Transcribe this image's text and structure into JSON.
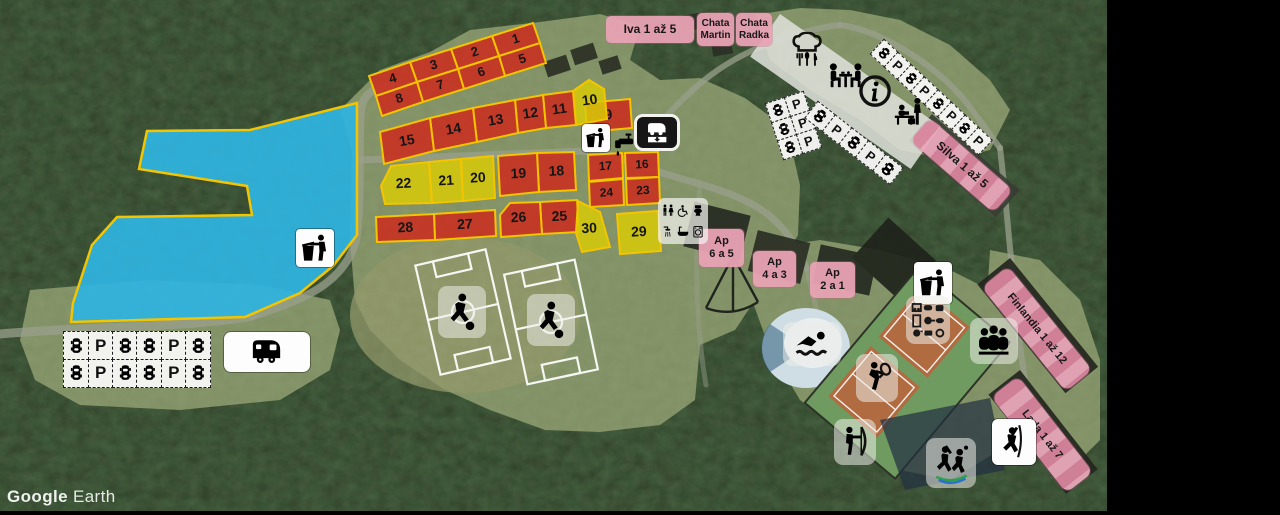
{
  "watermark": {
    "brand": "Google",
    "product": "Earth"
  },
  "colors": {
    "plot_red": "#cd2a1d",
    "plot_yellow": "#d8ca08",
    "plot_border": "#f3c400",
    "lake_fill": "#2fb4e0",
    "label_pink": "#e8a2b4",
    "forest": "#2c3c24",
    "meadow": "#7f8f63"
  },
  "lake": {
    "points": "357,103 250,130 147,131 139,169 247,186 252,215 117,217 92,245 73,303 71,322 245,317 300,293 333,266 357,235"
  },
  "plots": [
    {
      "n": "1",
      "c": "r",
      "fs": 13,
      "tr": -17,
      "pts": "492,36 533,23 540,43 499,56"
    },
    {
      "n": "2",
      "c": "r",
      "fs": 13,
      "tr": -17,
      "pts": "451,49 492,36 499,56 458,69"
    },
    {
      "n": "3",
      "c": "r",
      "fs": 13,
      "tr": -17,
      "pts": "410,62 451,49 458,69 417,82"
    },
    {
      "n": "4",
      "c": "r",
      "fs": 13,
      "tr": -17,
      "pts": "369,76 410,62 417,82 376,96"
    },
    {
      "n": "5",
      "c": "r",
      "fs": 13,
      "tr": -17,
      "pts": "499,56 540,43 546,63 505,76"
    },
    {
      "n": "6",
      "c": "r",
      "fs": 13,
      "tr": -17,
      "pts": "458,69 499,56 505,76 464,89"
    },
    {
      "n": "7",
      "c": "r",
      "fs": 13,
      "tr": -17,
      "pts": "417,82 458,69 464,89 423,102"
    },
    {
      "n": "8",
      "c": "r",
      "fs": 13,
      "tr": -17,
      "pts": "376,96 417,82 423,102 382,116"
    },
    {
      "n": "9",
      "c": "r",
      "fs": 14,
      "tr": -5,
      "pts": "585,103 630,99 632,128 587,132"
    },
    {
      "n": "10",
      "c": "y",
      "fs": 14,
      "tr": -8,
      "pts": "573,91 589,80 604,89 607,119 576,125"
    },
    {
      "n": "11",
      "c": "r",
      "fs": 14,
      "tr": -8,
      "pts": "543,95 573,91 576,125 546,128"
    },
    {
      "n": "12",
      "c": "r",
      "fs": 14,
      "tr": -8,
      "pts": "515,100 543,95 546,128 518,133"
    },
    {
      "n": "13",
      "c": "r",
      "fs": 14,
      "tr": -10,
      "pts": "473,108 515,100 518,133 477,142"
    },
    {
      "n": "14",
      "c": "r",
      "fs": 14,
      "tr": -10,
      "pts": "430,118 473,108 477,142 434,151"
    },
    {
      "n": "15",
      "c": "r",
      "fs": 14,
      "tr": -10,
      "pts": "380,132 430,118 434,151 384,164"
    },
    {
      "n": "16",
      "c": "r",
      "fs": 12,
      "tr": -3,
      "pts": "625,153 658,152 659,177 626,178"
    },
    {
      "n": "17",
      "c": "r",
      "fs": 12,
      "tr": -3,
      "pts": "588,155 622,153 623,178 589,181"
    },
    {
      "n": "18",
      "c": "r",
      "fs": 14,
      "tr": -3,
      "pts": "537,153 574,152 576,190 539,192"
    },
    {
      "n": "19",
      "c": "r",
      "fs": 14,
      "tr": -3,
      "pts": "498,156 537,153 539,192 500,196"
    },
    {
      "n": "20",
      "c": "y",
      "fs": 14,
      "tr": -3,
      "pts": "461,159 493,156 495,198 463,201"
    },
    {
      "n": "21",
      "c": "y",
      "fs": 14,
      "tr": -3,
      "pts": "429,162 461,159 463,201 432,203"
    },
    {
      "n": "22",
      "c": "y",
      "fs": 14,
      "tr": -3,
      "pts": "391,166 429,162 432,203 385,204 381,186"
    },
    {
      "n": "23",
      "c": "r",
      "fs": 12,
      "tr": -3,
      "pts": "626,179 659,177 660,203 627,205"
    },
    {
      "n": "24",
      "c": "r",
      "fs": 12,
      "tr": -3,
      "pts": "589,182 623,179 624,205 590,207"
    },
    {
      "n": "25",
      "c": "r",
      "fs": 14,
      "tr": -3,
      "pts": "540,202 577,200 579,232 542,234"
    },
    {
      "n": "26",
      "c": "r",
      "fs": 14,
      "tr": -3,
      "pts": "500,215 510,203 540,202 542,234 501,237"
    },
    {
      "n": "27",
      "c": "r",
      "fs": 14,
      "tr": -3,
      "pts": "434,214 495,210 496,236 435,240"
    },
    {
      "n": "28",
      "c": "r",
      "fs": 14,
      "tr": -3,
      "pts": "376,217 434,214 435,240 377,242"
    },
    {
      "n": "29",
      "c": "y",
      "fs": 14,
      "tr": -3,
      "pts": "617,214 658,211 661,251 620,254"
    },
    {
      "n": "30",
      "c": "y",
      "fs": 14,
      "tr": -3,
      "pts": "578,201 600,212 610,247 582,252 576,233"
    }
  ],
  "labels": [
    {
      "id": "iva",
      "lines": [
        "Iva  1 až 5"
      ],
      "x": 606,
      "y": 16,
      "w": 88,
      "h": 27,
      "rot": 0,
      "fs": 12,
      "type": "tag"
    },
    {
      "id": "chata-martin",
      "lines": [
        "Chata",
        "Martin"
      ],
      "x": 697,
      "y": 13,
      "w": 37,
      "h": 33,
      "rot": 0,
      "fs": 10,
      "type": "tag"
    },
    {
      "id": "chata-radka",
      "lines": [
        "Chata",
        "Radka"
      ],
      "x": 736,
      "y": 13,
      "w": 36,
      "h": 33,
      "rot": 0,
      "fs": 10,
      "type": "tag"
    },
    {
      "id": "silva",
      "lines": [
        "Silva  1 až 5"
      ],
      "x": 930,
      "y": 118,
      "w": 110,
      "h": 30,
      "rot": 41,
      "fs": 12,
      "type": "strip"
    },
    {
      "id": "ap-6-5",
      "lines": [
        "Ap",
        "6 a 5"
      ],
      "x": 699,
      "y": 229,
      "w": 45,
      "h": 38,
      "rot": 0,
      "fs": 11,
      "type": "tag"
    },
    {
      "id": "ap-4-3",
      "lines": [
        "Ap",
        "4 a 3"
      ],
      "x": 753,
      "y": 251,
      "w": 43,
      "h": 36,
      "rot": 0,
      "fs": 11,
      "type": "tag"
    },
    {
      "id": "ap-2-1",
      "lines": [
        "Ap",
        "2 a 1"
      ],
      "x": 810,
      "y": 262,
      "w": 45,
      "h": 36,
      "rot": 0,
      "fs": 11,
      "type": "tag"
    },
    {
      "id": "finlandia",
      "lines": [
        "Finlandia 1 až 12"
      ],
      "x": 1008,
      "y": 266,
      "w": 134,
      "h": 34,
      "rot": 51,
      "fs": 11,
      "type": "strip"
    },
    {
      "id": "lada",
      "lines": [
        "Lada 1 až 7"
      ],
      "x": 1018,
      "y": 376,
      "w": 122,
      "h": 34,
      "rot": 52,
      "fs": 11,
      "type": "strip"
    }
  ],
  "parking": {
    "p_label": "P",
    "strips": [
      {
        "id": "lot-main",
        "x": 64,
        "y": 332,
        "rot": 0,
        "cw": 26,
        "ch": 29,
        "rows": [
          [
            "car",
            "p",
            "car",
            "car",
            "p",
            "car"
          ],
          [
            "car",
            "p",
            "car",
            "car",
            "p",
            "car"
          ]
        ]
      },
      {
        "id": "row-northeast",
        "x": 884,
        "y": 40,
        "rot": 43,
        "cw": 20,
        "ch": 21,
        "rows": [
          [
            "car",
            "p",
            "car",
            "p",
            "car",
            "p",
            "car",
            "p"
          ]
        ]
      },
      {
        "id": "block-west",
        "x": 766,
        "y": 104,
        "rot": -18,
        "cw": 21,
        "ch": 21,
        "rows": [
          [
            "car",
            "p"
          ],
          [
            "car",
            "p"
          ],
          [
            "car",
            "p"
          ]
        ]
      },
      {
        "id": "row-mid",
        "x": 818,
        "y": 102,
        "rot": 38,
        "cw": 23,
        "ch": 22,
        "rows": [
          [
            "car",
            "p",
            "car",
            "p",
            "car"
          ]
        ]
      }
    ]
  },
  "facilities": [
    "waste-disposal-lake",
    "waste-disposal-camp",
    "water-tap",
    "chemical-wc-dump-station",
    "sanitary-block",
    "restaurant-kitchen",
    "dining-room",
    "information",
    "reception",
    "caravan-stand",
    "swimming-pool",
    "kitchen-equipment",
    "meeting-room",
    "waste-disposal-east",
    "tennis",
    "archery",
    "trampoline-games",
    "climbing",
    "football-field-1",
    "football-field-2"
  ]
}
